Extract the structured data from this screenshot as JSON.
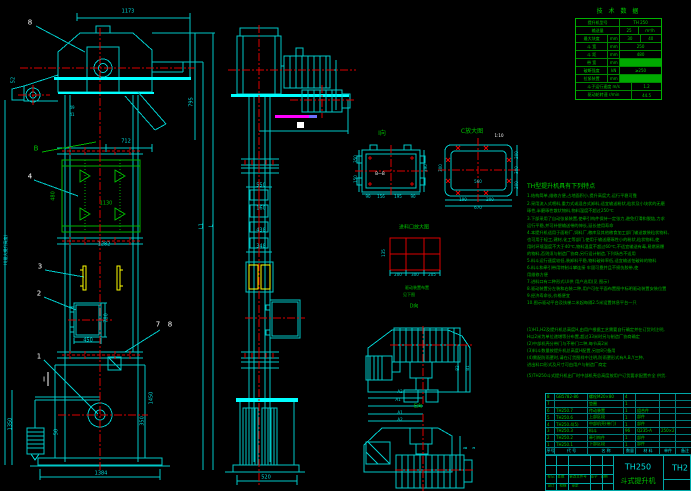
{
  "canvas": {
    "width": 691,
    "height": 491,
    "background": "#000000"
  },
  "colors": {
    "cyan": "#00dcdc",
    "green": "#00c000",
    "red": "#dd0000",
    "yellow": "#ffff00",
    "magenta": "#ff00ff",
    "white": "#ffffff"
  },
  "spec_table": {
    "title": "技 术 数 据",
    "rows": [
      {
        "cells": [
          {
            "t": "提升机型号",
            "w": 52
          },
          {
            "t": "TH 250",
            "w": 48
          }
        ]
      },
      {
        "cells": [
          {
            "t": "输送量",
            "w": 52
          },
          {
            "t": "25",
            "w": 22
          },
          {
            "t": "m³/h",
            "w": 26
          }
        ]
      },
      {
        "cells": [
          {
            "t": "最大块度",
            "w": 38
          },
          {
            "t": "mm",
            "w": 14
          },
          {
            "t": "30",
            "w": 24
          },
          {
            "t": "40",
            "w": 24
          }
        ]
      },
      {
        "cells": [
          {
            "t": "斗 宽",
            "w": 38
          },
          {
            "t": "mm",
            "w": 14
          },
          {
            "t": "250",
            "w": 48
          }
        ]
      },
      {
        "cells": [
          {
            "t": "斗 距",
            "w": 38
          },
          {
            "t": "mm",
            "w": 14
          },
          {
            "t": "480",
            "w": 48
          }
        ]
      },
      {
        "cells": [
          {
            "t": "带 宽",
            "w": 38
          },
          {
            "t": "mm",
            "w": 14
          },
          {
            "t": "",
            "w": 48,
            "hl": true
          }
        ]
      },
      {
        "cells": [
          {
            "t": "破断强度",
            "w": 38
          },
          {
            "t": "kN",
            "w": 14
          },
          {
            "t": "≥250",
            "w": 48
          }
        ]
      },
      {
        "cells": [
          {
            "t": "拉紧装置",
            "w": 38
          },
          {
            "t": "mm",
            "w": 14
          },
          {
            "t": "",
            "w": 48,
            "hl": true
          }
        ]
      },
      {
        "cells": [
          {
            "t": "斗子运行速度 m/s",
            "w": 66
          },
          {
            "t": "1.2",
            "w": 34
          }
        ]
      },
      {
        "cells": [
          {
            "t": "驱动轮转速 r/min",
            "w": 66
          },
          {
            "t": "44.5",
            "w": 34
          }
        ]
      }
    ]
  },
  "features": {
    "title": "TH型提升机具有下列特点",
    "lines": [
      {
        "y": 196,
        "t": "1.结构简单,维修方便,占地面积小,提升高度大,运行平稳可靠"
      },
      {
        "y": 204,
        "t": "2.采用流入式喂料,重力式或混合式卸料,适宜输送粉状,粒状及小块状的无磨"
      },
      {
        "y": 211,
        "t": "  琢性,半磨琢性散状物料,物料温度不超过250℃"
      },
      {
        "y": 219,
        "t": "3.下部采用了自动张紧装置,使牵引构件保持一定张力,避免打滑和脱链,力求"
      },
      {
        "y": 226,
        "t": "  运行平稳,并可补偿输送带的伸长,延长使用寿命"
      },
      {
        "y": 233,
        "t": "4.本提升机适用于面粉厂,饲料厂,粮库及其他粮食加工部门输送散装粒状物料,"
      },
      {
        "y": 240,
        "t": "  也可用于轻工,建材,化工等部门,使用于输送磨琢性小的粉状,粒状物料,使"
      },
      {
        "y": 247,
        "t": "  用时环境温度不大于40℃,物料温度不超过60℃,不适宜输送有毒,易燃易爆"
      },
      {
        "y": 254,
        "t": "  的物料,否则须与制造厂协商,另行设计制造,下列场合不适用"
      },
      {
        "y": 261,
        "t": "5.料斗运行速度较低,装卸料平稳,物料破碎率低,适宜输送怕破碎的物料"
      },
      {
        "y": 268,
        "t": "6.料斗和牵引带用特制斗攀连接           牢固可靠并且不损伤胶带,使"
      },
      {
        "y": 275,
        "t": "  用维修方便"
      },
      {
        "y": 282,
        "t": "7.进料口有二种形式I,II供 用户选用(见 图示)"
      },
      {
        "y": 289,
        "t": "8.驱动装置分左装和右装二种,用户可在平面布置图中标明驱动装置安装位置"
      },
      {
        "y": 296,
        "t": "9.经济寿命长,价格便宜"
      },
      {
        "y": 303,
        "t": "10.图示驱动平台及扶梯二米起每隔2.5米设置休息平台一只"
      },
      {
        "y": 330,
        "t": "(1)H1,H2及提升机总高度H,由用户根据工艺需要自行确定并在订货时注明,"
      },
      {
        "y": 337,
        "t": "  H以2米为单位递增等分布置,超过33米时另与制造厂协商确定"
      },
      {
        "y": 344,
        "t": "(2)中部机壳分带门与不带门二种,每节高2米"
      },
      {
        "y": 351,
        "t": "(3)料斗数量按提升机总高度H配置,另加8只备用"
      },
      {
        "y": 358,
        "t": "(4)需配防雨罩时,请在订货图样中注明,防雨罩形式有A,B,Y三种,"
      },
      {
        "y": 365,
        "t": "  进出料口形式及尺寸可由用户与制造厂商定"
      },
      {
        "y": 376,
        "t": "(5)TH250斗式提升机出厂时中部机壳总高度按用户订货要求配置齐全 供货."
      }
    ]
  },
  "parts_table": {
    "col_widths": [
      9,
      33,
      36,
      12,
      24,
      16,
      18
    ],
    "rows": [
      [
        "8",
        "GB5782-86",
        "螺栓M20×80",
        "4",
        "",
        "",
        ""
      ],
      [
        "7",
        "",
        "垫圈",
        "1",
        "",
        "",
        ""
      ],
      [
        "6",
        "TH250.7",
        "传动装置",
        "1",
        "组合件",
        "",
        ""
      ],
      [
        "5",
        "TH250.6",
        "上部区段",
        "1",
        "部件",
        "",
        ""
      ],
      [
        "4",
        "TH250.4(5)",
        "中部机壳(带门)",
        "1",
        "部件",
        "",
        ""
      ],
      [
        "3",
        "TH250.3",
        "料斗",
        "96",
        "Q235-A",
        "250×2",
        ""
      ],
      [
        "2",
        "TH250.2",
        "牵引构件",
        "1",
        "部件",
        "",
        ""
      ],
      [
        "1",
        "TH250.1",
        "下部区段",
        "1",
        "部件",
        "",
        ""
      ]
    ],
    "header": [
      "序号",
      "代 号",
      "名 称",
      "数量",
      "材 料",
      "单件",
      "备注"
    ]
  },
  "title_block": {
    "model": "TH250",
    "product_name": "斗式提升机",
    "drawing_no": "TH2",
    "rev_labels": [
      {
        "t": "标记",
        "x": 551,
        "y": 477
      },
      {
        "t": "处数",
        "x": 561,
        "y": 477
      },
      {
        "t": "更改文件号",
        "x": 578,
        "y": 477
      },
      {
        "t": "签字",
        "x": 594,
        "y": 477
      },
      {
        "t": "日期",
        "x": 604,
        "y": 477
      },
      {
        "t": "设计",
        "x": 551,
        "y": 486
      },
      {
        "t": "校核",
        "x": 563,
        "y": 486
      },
      {
        "t": "审定",
        "x": 575,
        "y": 486
      }
    ]
  },
  "labels": [
    {
      "t": "1173",
      "x": 128,
      "y": 12,
      "c": "cyan"
    },
    {
      "t": "8",
      "x": 30,
      "y": 23,
      "c": "white",
      "s": 7
    },
    {
      "t": "795",
      "x": 192,
      "y": 102,
      "c": "cyan",
      "r": 1
    },
    {
      "t": "52",
      "x": 14,
      "y": 80,
      "c": "cyan",
      "r": 1
    },
    {
      "t": "49",
      "x": 72,
      "y": 108,
      "c": "cyan",
      "s": 4
    },
    {
      "t": "41",
      "x": 72,
      "y": 115,
      "c": "cyan",
      "s": 4
    },
    {
      "t": "712",
      "x": 126,
      "y": 142,
      "c": "cyan"
    },
    {
      "t": "B",
      "x": 36,
      "y": 149,
      "c": "green",
      "s": 7
    },
    {
      "t": "4",
      "x": 30,
      "y": 177,
      "c": "white",
      "s": 7
    },
    {
      "t": "480",
      "x": 54,
      "y": 196,
      "c": "green",
      "r": 1
    },
    {
      "t": "1130",
      "x": 106,
      "y": 204,
      "c": "green"
    },
    {
      "t": "1282",
      "x": 104,
      "y": 245,
      "c": "cyan"
    },
    {
      "t": "H(最大提升高度)",
      "x": 6,
      "y": 250,
      "c": "cyan",
      "r": 1,
      "s": 4
    },
    {
      "t": "3",
      "x": 40,
      "y": 267,
      "c": "white",
      "s": 7
    },
    {
      "t": "2",
      "x": 39,
      "y": 294,
      "c": "white",
      "s": 7
    },
    {
      "t": "780",
      "x": 107,
      "y": 318,
      "c": "cyan",
      "r": 1
    },
    {
      "t": "450",
      "x": 88,
      "y": 341,
      "c": "cyan"
    },
    {
      "t": "7",
      "x": 158,
      "y": 325,
      "c": "white",
      "s": 7
    },
    {
      "t": "8",
      "x": 170,
      "y": 325,
      "c": "white",
      "s": 7
    },
    {
      "t": "1",
      "x": 39,
      "y": 357,
      "c": "white",
      "s": 7
    },
    {
      "t": "I",
      "x": 44,
      "y": 380,
      "c": "white",
      "s": 7
    },
    {
      "t": "1350",
      "x": 11,
      "y": 424,
      "c": "cyan",
      "r": 1
    },
    {
      "t": "50",
      "x": 57,
      "y": 432,
      "c": "cyan",
      "r": 1
    },
    {
      "t": "1450",
      "x": 152,
      "y": 398,
      "c": "cyan",
      "r": 1
    },
    {
      "t": "350",
      "x": 143,
      "y": 421,
      "c": "cyan",
      "r": 1
    },
    {
      "t": "1384",
      "x": 101,
      "y": 474,
      "c": "cyan"
    },
    {
      "t": "L1",
      "x": 202,
      "y": 226,
      "c": "cyan",
      "r": 1
    },
    {
      "t": "L",
      "x": 212,
      "y": 226,
      "c": "cyan",
      "r": 1
    },
    {
      "t": "550",
      "x": 261,
      "y": 186,
      "c": "cyan"
    },
    {
      "t": "160",
      "x": 261,
      "y": 209,
      "c": "cyan"
    },
    {
      "t": "438",
      "x": 261,
      "y": 231,
      "c": "cyan"
    },
    {
      "t": "348",
      "x": 261,
      "y": 247,
      "c": "cyan"
    },
    {
      "t": "520",
      "x": 266,
      "y": 478,
      "c": "cyan"
    },
    {
      "t": "I向",
      "x": 382,
      "y": 134,
      "c": "green",
      "s": 6
    },
    {
      "t": "350",
      "x": 356,
      "y": 159,
      "c": "cyan",
      "r": 1,
      "s": 4
    },
    {
      "t": "150",
      "x": 356,
      "y": 179,
      "c": "cyan",
      "r": 1,
      "s": 4
    },
    {
      "t": "B—B",
      "x": 380,
      "y": 174,
      "c": "white",
      "s": 4
    },
    {
      "t": "390",
      "x": 426,
      "y": 168,
      "c": "cyan",
      "r": 1,
      "s": 4
    },
    {
      "t": "90",
      "x": 368,
      "y": 197,
      "c": "cyan",
      "s": 4
    },
    {
      "t": "156",
      "x": 381,
      "y": 197,
      "c": "cyan",
      "s": 4
    },
    {
      "t": "195",
      "x": 398,
      "y": 197,
      "c": "cyan",
      "s": 4
    },
    {
      "t": "90",
      "x": 413,
      "y": 197,
      "c": "cyan",
      "s": 4
    },
    {
      "t": "C放大图",
      "x": 472,
      "y": 132,
      "c": "green",
      "s": 6
    },
    {
      "t": "1:10",
      "x": 499,
      "y": 136,
      "c": "white",
      "s": 4
    },
    {
      "t": "300",
      "x": 441,
      "y": 168,
      "c": "cyan",
      "r": 1,
      "s": 4
    },
    {
      "t": "560",
      "x": 478,
      "y": 182,
      "c": "cyan",
      "s": 4
    },
    {
      "t": "200",
      "x": 517,
      "y": 155,
      "c": "cyan",
      "r": 1,
      "s": 4
    },
    {
      "t": "300",
      "x": 517,
      "y": 170,
      "c": "cyan",
      "r": 1,
      "s": 4
    },
    {
      "t": "200",
      "x": 517,
      "y": 185,
      "c": "cyan",
      "r": 1,
      "s": 4
    },
    {
      "t": "190",
      "x": 463,
      "y": 200,
      "c": "cyan",
      "s": 4
    },
    {
      "t": "200",
      "x": 490,
      "y": 200,
      "c": "cyan",
      "s": 4
    },
    {
      "t": "670",
      "x": 478,
      "y": 208,
      "c": "cyan",
      "s": 4
    },
    {
      "t": "进料口放大图",
      "x": 414,
      "y": 228,
      "c": "green",
      "s": 5
    },
    {
      "t": "135",
      "x": 384,
      "y": 253,
      "c": "cyan",
      "r": 1,
      "s": 4
    },
    {
      "t": "200",
      "x": 398,
      "y": 275,
      "c": "cyan",
      "s": 4
    },
    {
      "t": "300",
      "x": 415,
      "y": 275,
      "c": "cyan",
      "s": 4
    },
    {
      "t": "205",
      "x": 432,
      "y": 275,
      "c": "cyan",
      "s": 4
    },
    {
      "t": "驱动装置布置",
      "x": 417,
      "y": 288,
      "c": "green",
      "s": 4
    },
    {
      "t": "见下图",
      "x": 409,
      "y": 295,
      "c": "green",
      "s": 4
    },
    {
      "t": "D向",
      "x": 414,
      "y": 307,
      "c": "green",
      "s": 5
    },
    {
      "t": "B2",
      "x": 458,
      "y": 368,
      "c": "cyan",
      "r": 1,
      "s": 4
    },
    {
      "t": "B1",
      "x": 468,
      "y": 368,
      "c": "cyan",
      "r": 1,
      "s": 4
    },
    {
      "t": "A2",
      "x": 400,
      "y": 392,
      "c": "cyan",
      "s": 4
    },
    {
      "t": "A1",
      "x": 398,
      "y": 400,
      "c": "cyan",
      "s": 4
    },
    {
      "t": "E向",
      "x": 418,
      "y": 407,
      "c": "green",
      "s": 5
    },
    {
      "t": "A1",
      "x": 400,
      "y": 413,
      "c": "cyan",
      "s": 4
    },
    {
      "t": "A2",
      "x": 400,
      "y": 420,
      "c": "cyan",
      "s": 4
    },
    {
      "t": "B",
      "x": 466,
      "y": 448,
      "c": "cyan",
      "r": 1,
      "s": 4
    },
    {
      "t": "a",
      "x": 474,
      "y": 448,
      "c": "cyan",
      "r": 1,
      "s": 4
    }
  ]
}
